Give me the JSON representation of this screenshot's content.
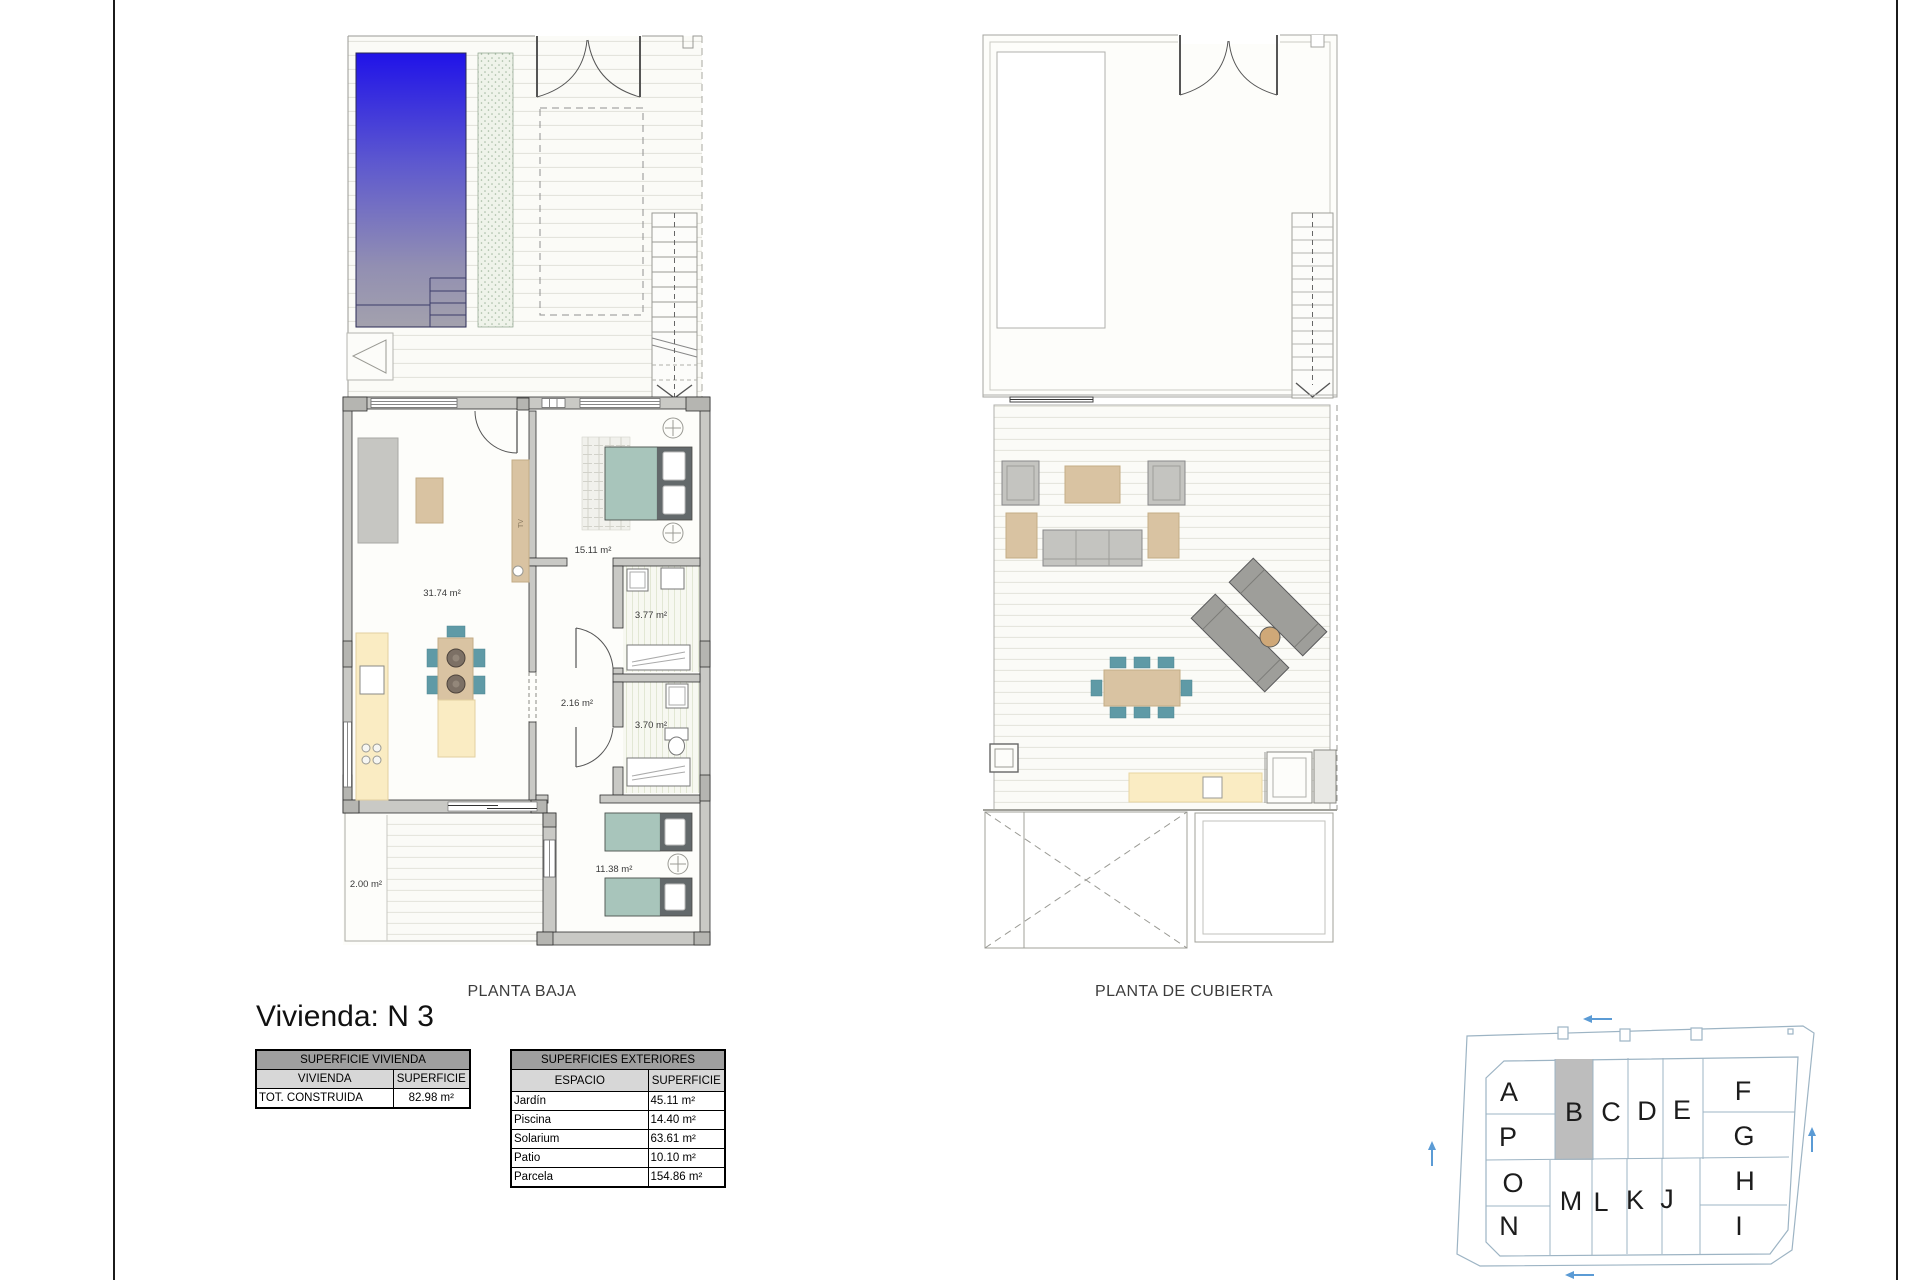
{
  "title": "Vivienda: N 3",
  "plans": {
    "planta_baja": {
      "caption": "PLANTA BAJA",
      "tv_label": "TV",
      "rooms": [
        {
          "id": "living-kitchen",
          "label": "31.74 m²"
        },
        {
          "id": "bedroom-1",
          "label": "15.11 m²"
        },
        {
          "id": "bathroom-1",
          "label": "3.77 m²"
        },
        {
          "id": "hall",
          "label": "2.16 m²"
        },
        {
          "id": "bathroom-2",
          "label": "3.70 m²"
        },
        {
          "id": "bedroom-2",
          "label": "11.38 m²"
        },
        {
          "id": "patio",
          "label": "2.00 m²"
        }
      ]
    },
    "planta_cubierta": {
      "caption": "PLANTA DE CUBIERTA"
    }
  },
  "tables": {
    "vivienda": {
      "title": "SUPERFICIE VIVIENDA",
      "headers": [
        "VIVIENDA",
        "SUPERFICIE"
      ],
      "rows": [
        [
          "TOT. CONSTRUIDA",
          "82.98 m²"
        ]
      ]
    },
    "exteriores": {
      "title": "SUPERFICIES EXTERIORES",
      "headers": [
        "ESPACIO",
        "SUPERFICIE"
      ],
      "rows": [
        [
          "Jardín",
          "45.11 m²"
        ],
        [
          "Piscina",
          "14.40 m²"
        ],
        [
          "Solarium",
          "63.61 m²"
        ],
        [
          "Patio",
          "10.10 m²"
        ],
        [
          "Parcela",
          "154.86 m²"
        ]
      ]
    }
  },
  "site_plan": {
    "highlighted_unit": "B",
    "units": [
      "A",
      "P",
      "B",
      "C",
      "D",
      "E",
      "F",
      "G",
      "O",
      "N",
      "M",
      "L",
      "K",
      "J",
      "H",
      "I"
    ]
  },
  "colors": {
    "pool_top": "#2013e8",
    "pool_bottom": "#a3a1ad",
    "wall_gray": "#c9c9c5",
    "wood_tan": "#d9c3a2",
    "counter_yellow": "#faecc3",
    "bed_teal": "#a8c5bb",
    "chair_teal": "#5f9aa6",
    "sofa_gray": "#c6c6c2",
    "site_highlight": "#bdbdbd",
    "site_line": "#9db4c4",
    "arrow_blue": "#5b9bd5"
  }
}
